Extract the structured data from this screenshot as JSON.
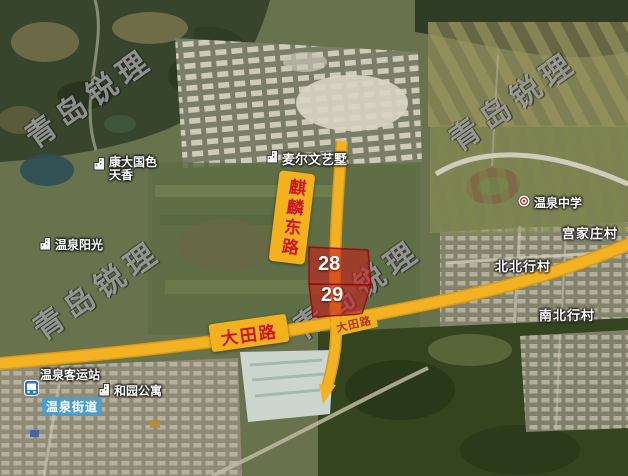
{
  "watermark_text": "青岛锐理",
  "roads": {
    "qilin_east": "麒麟东路",
    "datian_badge": "大田路",
    "datian_onroad": "大田路"
  },
  "parcels": {
    "n28": "28",
    "n29": "29"
  },
  "places": {
    "kangda_line1": "康大国色",
    "kangda_line2": "天香",
    "maierwen": "麦尔文艺墅",
    "wenquan_sunshine": "温泉阳光",
    "wenquan_middle_school": "温泉中学",
    "gongjiazhuang_village": "宫家庄村",
    "beibeixing_village": "北北行村",
    "nanbeixing_village": "南北行村",
    "bus_station": "温泉客运站",
    "heyuan_apartments": "和园公寓",
    "wenquan_subdistrict": "温泉街道"
  },
  "colors": {
    "road_yellow": "#f3b224",
    "badge_yellow": "#f4b11e",
    "badge_text_red": "#cf1421",
    "parcel_red": "#c61c1c",
    "subdistrict_blue": "#489ed4"
  }
}
